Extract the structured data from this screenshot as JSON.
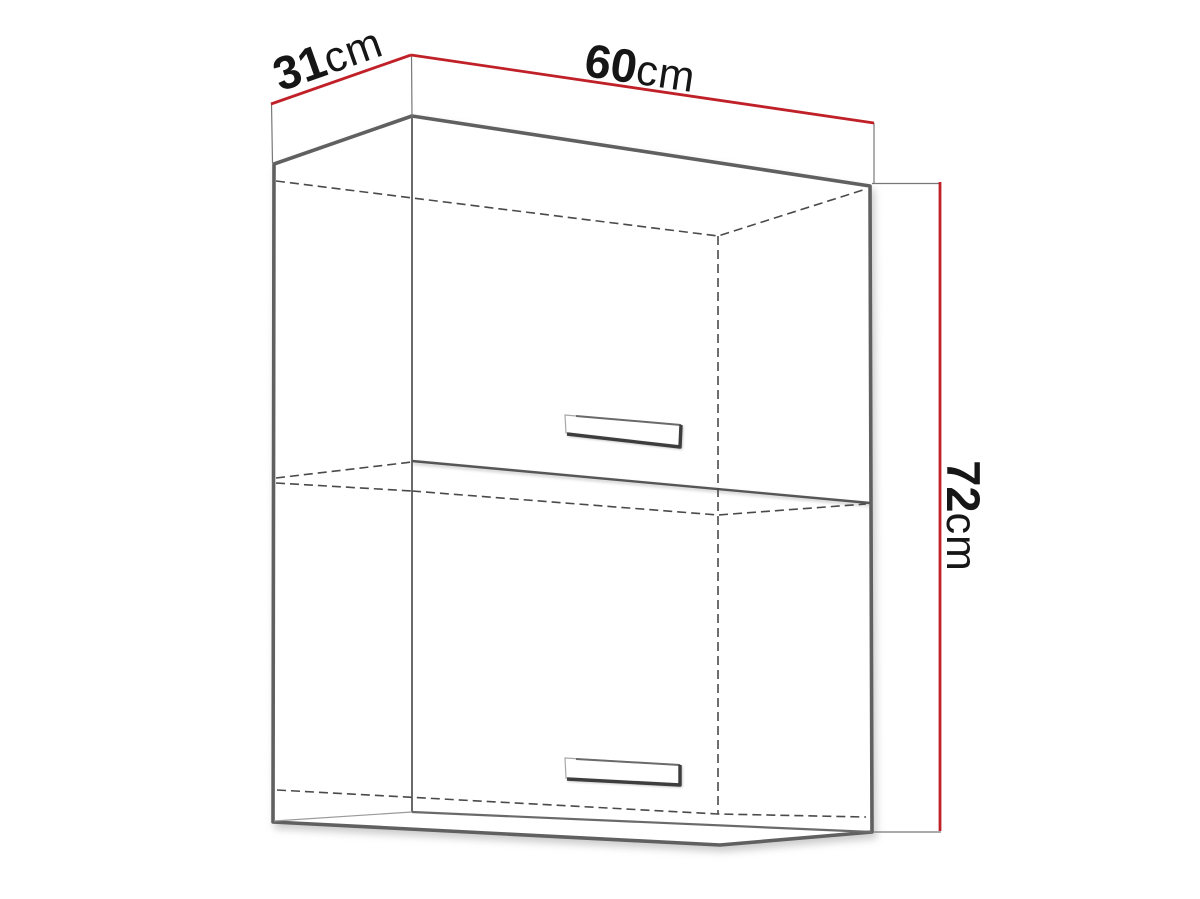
{
  "diagram": {
    "type": "furniture-dimension-drawing",
    "labels": {
      "depth": {
        "value": "31",
        "unit": "cm"
      },
      "width": {
        "value": "60",
        "unit": "cm"
      },
      "height": {
        "value": "72",
        "unit": "cm"
      }
    },
    "colors": {
      "dimension_line": "#c02128",
      "cabinet_edge": "#606060",
      "hidden_edge": "#4a4a4a",
      "label_text": "#161616",
      "background": "#ffffff"
    }
  }
}
